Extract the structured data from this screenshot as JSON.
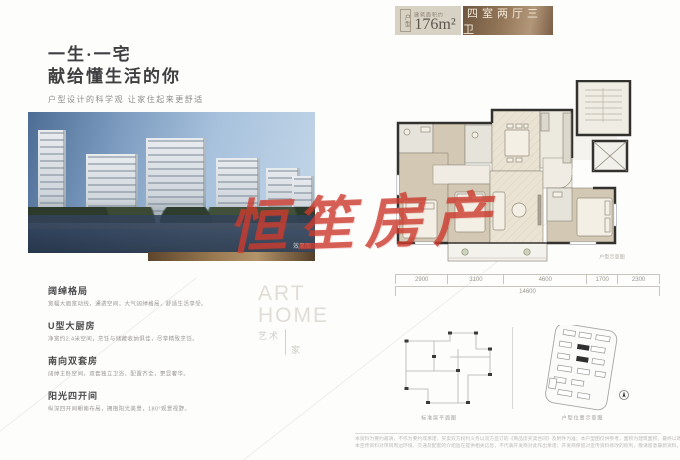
{
  "colors": {
    "accent_bronze": "#957859",
    "badge_beige": "#d8d2c5",
    "watermark_red": "#cc3b2e",
    "wall": "#33312e"
  },
  "header": {
    "tag": "户型",
    "area_label": "建筑面积约",
    "area_value": "176m²",
    "layout_label": "四室两厅三卫"
  },
  "left": {
    "title_line1": "一生·一宅",
    "title_line2": "献给懂生活的你",
    "subtitle": "户型设计的科学观 让家住起来更舒适",
    "photo_caption": "效果图",
    "features": [
      {
        "title": "阔绰格局",
        "desc": "宽幅大面宽动线，通透空间，大气阔绰格局，舒适生活享受。"
      },
      {
        "title": "U型大厨房",
        "desc": "净宽约2.4米空间，烹饪与储藏收纳俱佳，尽享精致烹饪。"
      },
      {
        "title": "南向双套房",
        "desc": "阔绰主卧空间，双套独立卫浴，配置齐全，更显奢华。"
      },
      {
        "title": "阳光四开间",
        "desc": "纵深四开间朝南布局，拥抱阳光美景，180°观景视野。"
      }
    ],
    "art": {
      "en1": "ART",
      "en2": "HOME",
      "cn1": "艺术",
      "cn2": "家"
    }
  },
  "watermark": {
    "text": "恒笙房产"
  },
  "plan": {
    "caption": "户型示意图",
    "dims": [
      "2900",
      "3100",
      "4600",
      "1700",
      "2300"
    ],
    "total": "14600"
  },
  "diagrams": {
    "left_caption": "标准层平面图",
    "right_caption": "户型位置示意图"
  },
  "footer": {
    "line1": "本资料为要约邀请，不作为要约或承诺，买卖双方权利义务以双方签订的《商品房买卖合同》及附件为准；本户型图仅供参考，面积为建筑面积，最终以政府部门核准图纸及实际交付为准。",
    "line2": "本宣传资料对项目周边环境、交通及配套的介绍旨在提供相关信息，不代表开发商对此作出承诺；开发商保留对宣传资料修改的权利，敬请留意最新资料。"
  }
}
